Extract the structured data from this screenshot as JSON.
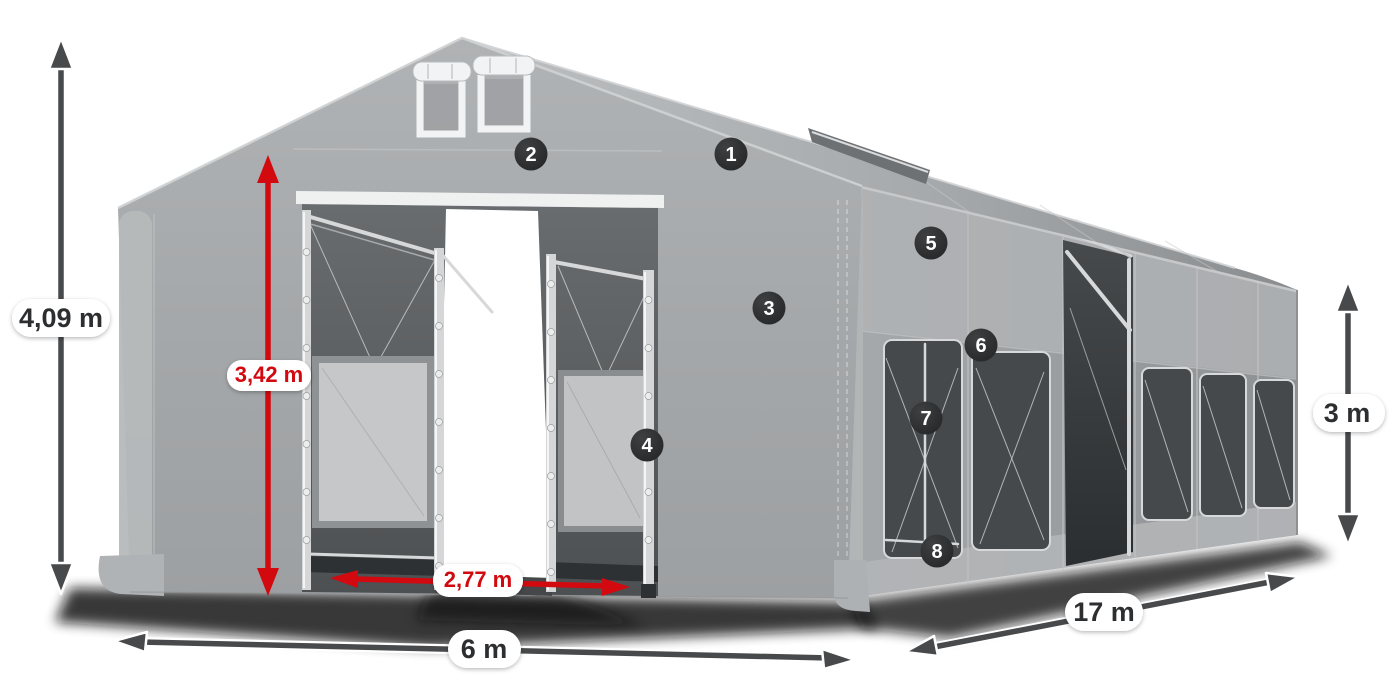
{
  "colors": {
    "background": "#ffffff",
    "fabric_gray": "#a7aaac",
    "window_dark": "#45494b",
    "accent_red": "#d2090f",
    "dimension_dark": "#47494b",
    "badge_background": "#27292b",
    "badge_text": "#ffffff",
    "label_pill_background": "#ffffff",
    "label_text_dark": "#2c2e30"
  },
  "dimensions": {
    "total_height": "4,09 m",
    "entrance_height": "3,42 m",
    "entrance_width": "2,77 m",
    "front_width": "6 m",
    "length": "17 m",
    "side_height": "3 m"
  },
  "callouts": [
    {
      "number": "1"
    },
    {
      "number": "2"
    },
    {
      "number": "3"
    },
    {
      "number": "4"
    },
    {
      "number": "5"
    },
    {
      "number": "6"
    },
    {
      "number": "7"
    },
    {
      "number": "8"
    }
  ]
}
